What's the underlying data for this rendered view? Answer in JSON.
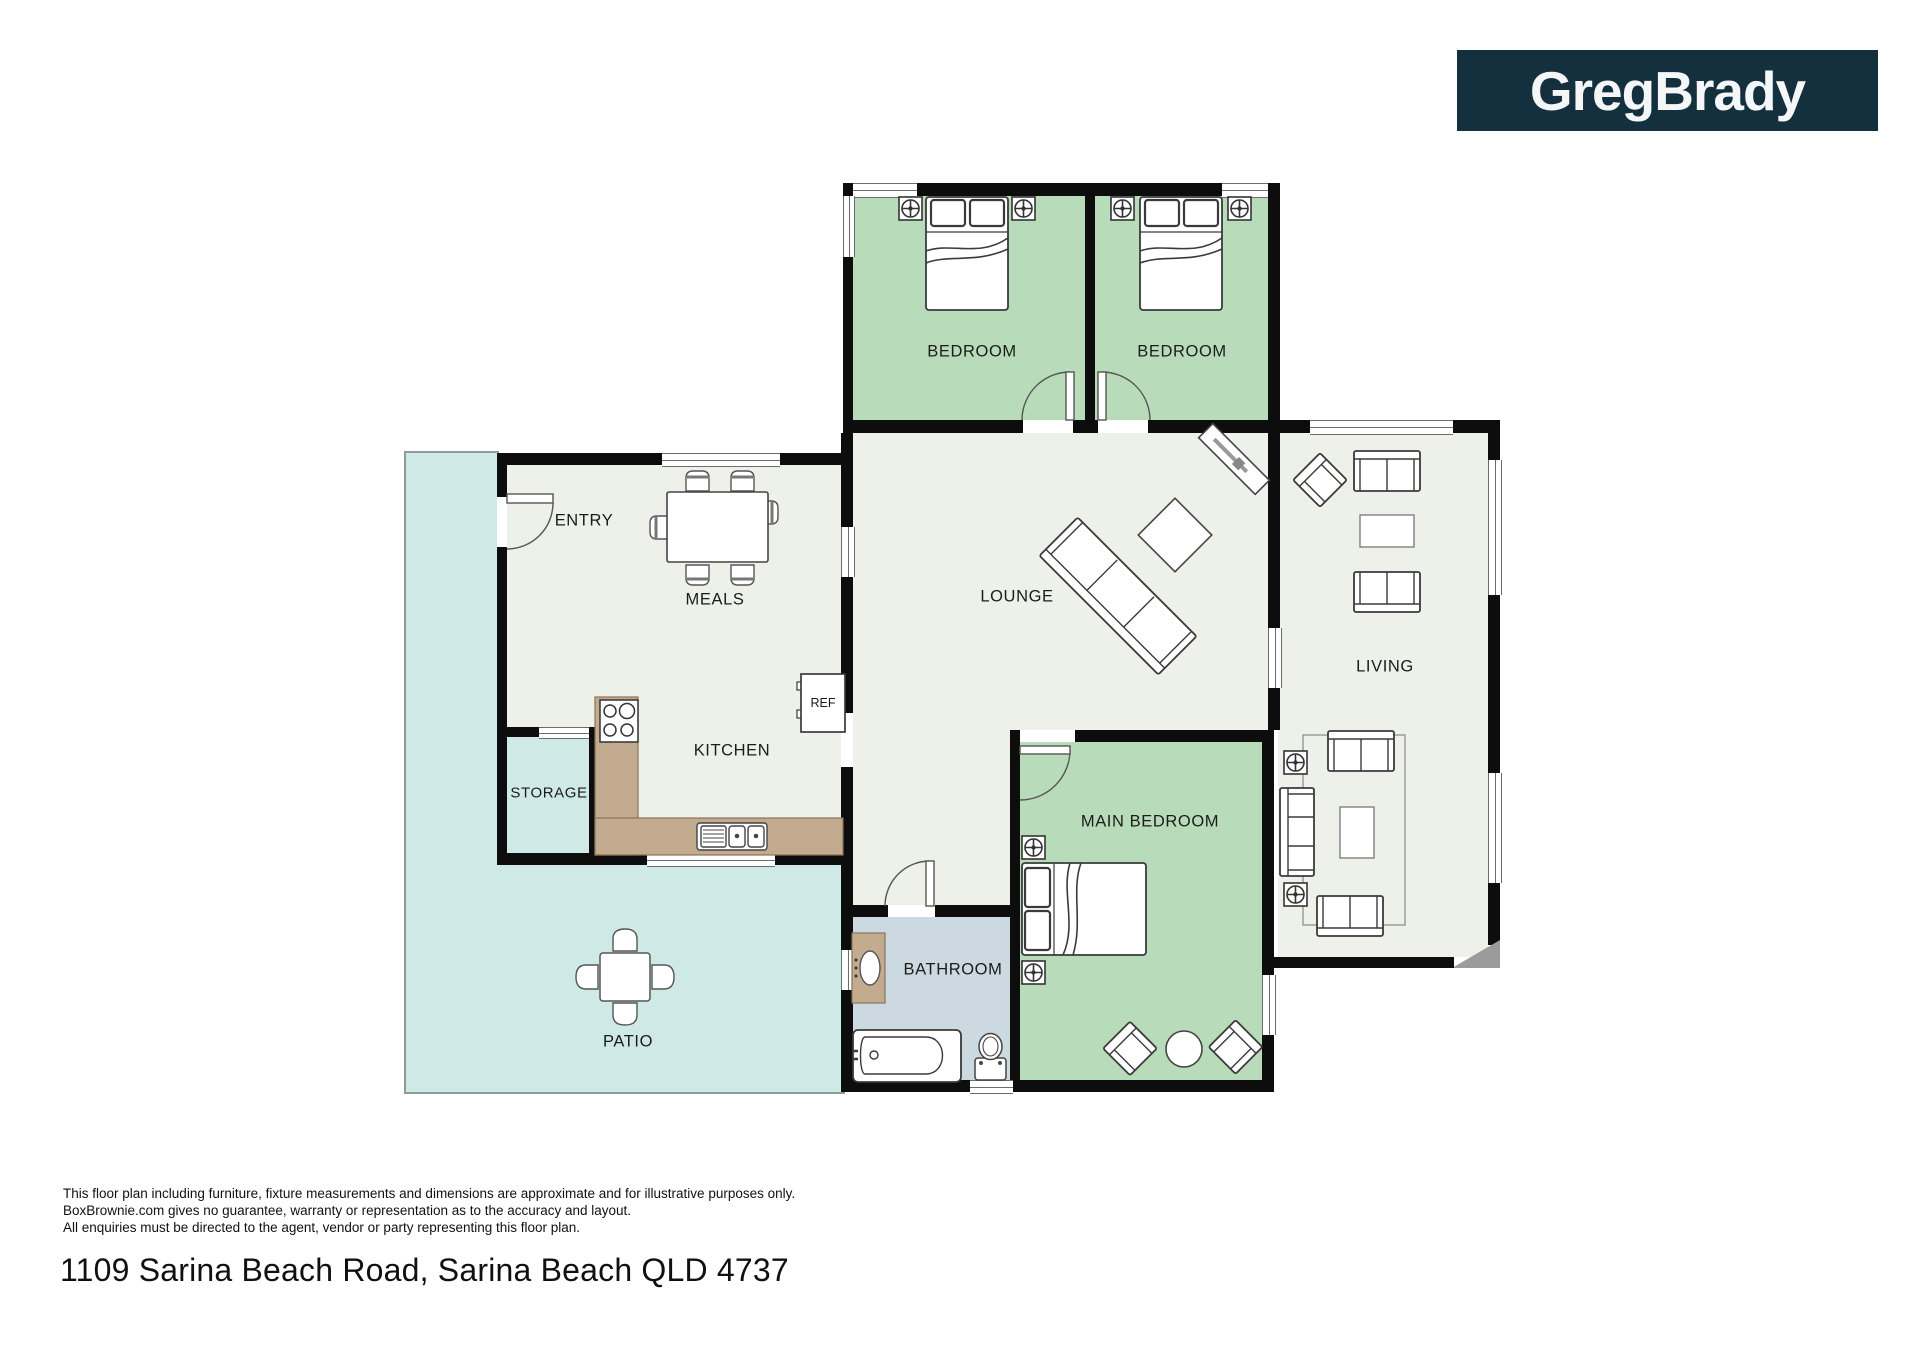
{
  "logo": {
    "text": "GregBrady"
  },
  "rooms": {
    "bedroom1": "BEDROOM",
    "bedroom2": "BEDROOM",
    "lounge": "LOUNGE",
    "living": "LIVING",
    "entry": "ENTRY",
    "meals": "MEALS",
    "kitchen": "KITCHEN",
    "storage": "STORAGE",
    "main_bedroom": "MAIN BEDROOM",
    "bathroom": "BATHROOM",
    "patio": "PATIO",
    "fridge": "REF"
  },
  "footer": {
    "disclaimer_lines": [
      "This floor plan including furniture, fixture measurements and dimensions are approximate and for illustrative purposes only.",
      "BoxBrownie.com gives no guarantee, warranty or representation as to the accuracy and layout.",
      "All enquiries must be directed to the agent, vendor or party representing this floor plan."
    ],
    "address": "1109 Sarina Beach Road, Sarina Beach QLD 4737"
  },
  "theme": {
    "green": "#b8dcb9",
    "floor": "#eef1ea",
    "cyan": "#cfe9e6",
    "bath": "#ccd9e1",
    "counter": "#c2ab8f",
    "counterEdge": "#8a7357",
    "wall": "#0d0d0d",
    "logoBg": "#14303e",
    "patioBorder": "#8f9b9b",
    "chamfer": "#9b9b9b"
  }
}
